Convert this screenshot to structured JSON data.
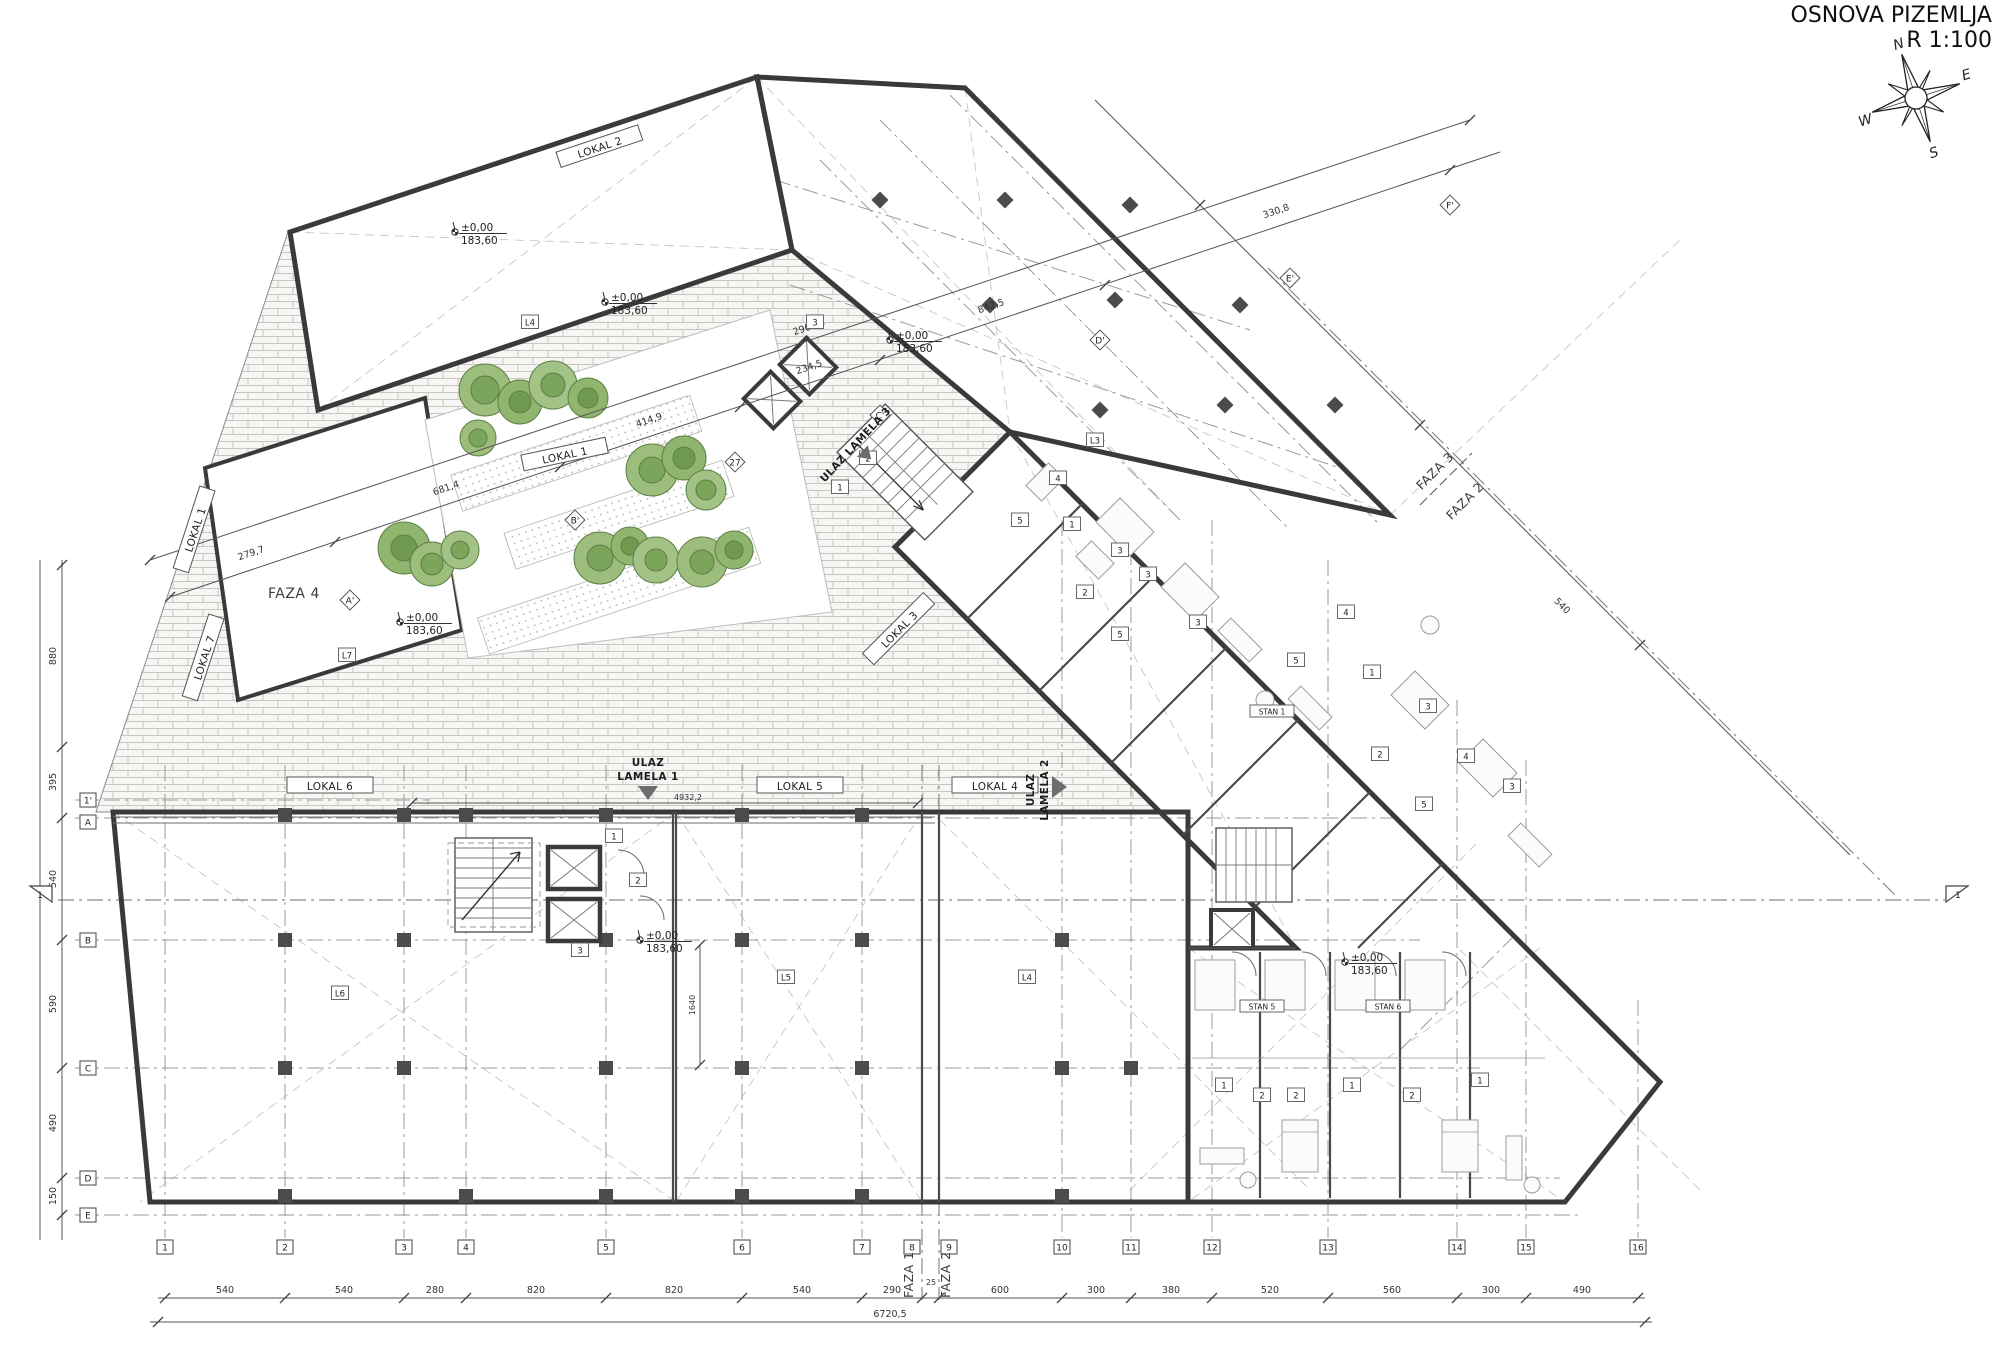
{
  "title": {
    "line1": "OSNOVA PIZEMLJA",
    "line2": "R 1:100"
  },
  "compass": {
    "n": "N",
    "e": "E",
    "s": "S",
    "w": "W"
  },
  "elevation": {
    "relative": "±0,00",
    "absolute": "183,60"
  },
  "phase_labels": {
    "faza1": "FAZA 1",
    "faza2": "FAZA 2",
    "faza3": "FAZA 3",
    "faza4": "FAZA 4"
  },
  "lokal_labels": {
    "lokal1": "LOKAL 1",
    "lokal2": "LOKAL 2",
    "lokal3": "LOKAL 3",
    "lokal4": "LOKAL 4",
    "lokal5": "LOKAL 5",
    "lokal6": "LOKAL 6",
    "lokal7": "LOKAL 7"
  },
  "room_tags": {
    "upper_hall": "L4",
    "upper_right_hall": "L3",
    "faza4_parcel": "L7",
    "retail_left": "L6",
    "retail_mid": "L5",
    "retail_right": "L4"
  },
  "entrance_labels": {
    "ulaz": "ULAZ",
    "lamela1": "LAMELA 1",
    "lamela2": "LAMELA 2",
    "lamela3": "ULAZ LAMELA 3"
  },
  "stan_labels": [
    "STAN 1",
    "STAN 5",
    "STAN 6"
  ],
  "unit_tags": {
    "core_top": [
      "3",
      "2",
      "1"
    ],
    "core_mid": [
      "1",
      "2",
      "3"
    ],
    "band_upper": [
      "4",
      "5",
      "1",
      "3",
      "2",
      "3",
      "5",
      "3"
    ],
    "band_mid": [
      "4",
      "5",
      "1",
      "3",
      "2",
      "4",
      "3",
      "5"
    ],
    "block_bottom": [
      "1",
      "2",
      "2",
      "1",
      "2",
      "1"
    ]
  },
  "grid": {
    "bottom": [
      "1",
      "2",
      "3",
      "4",
      "5",
      "6",
      "7",
      "8",
      "9",
      "10",
      "11",
      "12",
      "13",
      "14",
      "15",
      "16"
    ],
    "left": [
      "1'",
      "A",
      "B",
      "C",
      "D",
      "E"
    ],
    "top_diamonds": [
      "A'",
      "B'",
      "27",
      "C'",
      "D'",
      "E'",
      "F'"
    ],
    "section": "1"
  },
  "dimensions": {
    "bottom": [
      "540",
      "540",
      "280",
      "820",
      "820",
      "540",
      "290",
      "25",
      "600",
      "300",
      "380",
      "520",
      "560",
      "300",
      "490"
    ],
    "bottom_total": "6720,5",
    "top": [
      "279,7",
      "681,4",
      "414,9",
      "234,5",
      "842,5",
      "330,8"
    ],
    "top_total": "2900,5",
    "left": [
      "880",
      "395",
      "540",
      "590",
      "490",
      "150"
    ],
    "right": "540",
    "interior": "1640",
    "entry": "4932,2"
  }
}
